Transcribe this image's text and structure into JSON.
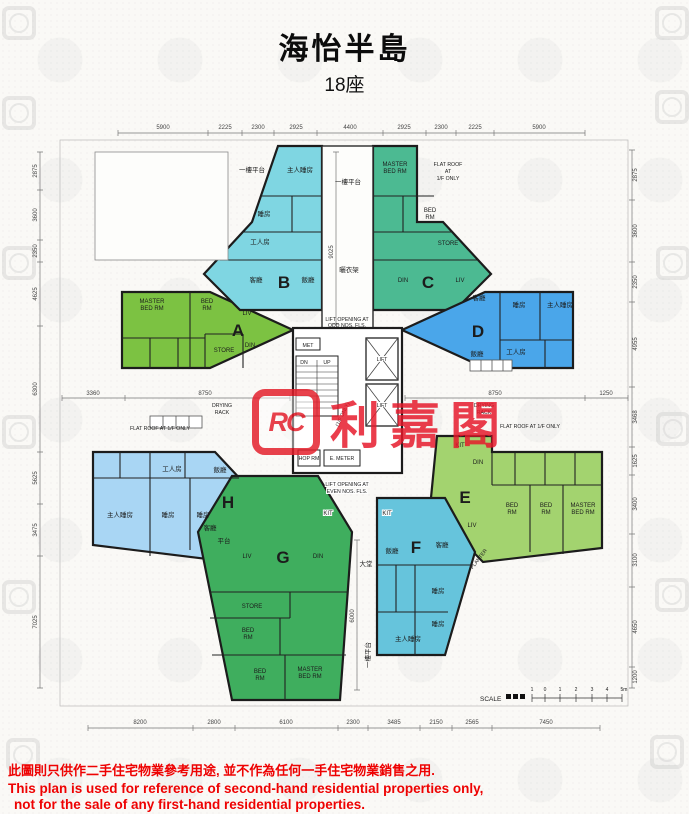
{
  "title": "海怡半島",
  "subtitle": "18座",
  "watermark": {
    "logo_text": "RC",
    "name": "利嘉閣"
  },
  "dims": {
    "top": [
      "5900",
      "2225",
      "2300",
      "2925",
      "4400",
      "2925",
      "2300",
      "2225",
      "5900"
    ],
    "bottom": [
      "8200",
      "2800",
      "6100",
      "2300",
      "3485",
      "2150",
      "2565",
      "7450"
    ],
    "left": [
      "2875",
      "3600",
      "2350",
      "4625",
      "6300",
      "5625",
      "3475",
      "7025"
    ],
    "right": [
      "2875",
      "3600",
      "2350",
      "4955",
      "3468",
      "1625",
      "3400",
      "3100",
      "4650",
      "1200"
    ],
    "mid": {
      "d3360": "3360",
      "d8750_left": "8750",
      "d8750_right": "8750",
      "d1250": "1250",
      "d9025": "9025",
      "d6000": "6000"
    }
  },
  "units": {
    "A": {
      "label": "A",
      "color": "#7cc242",
      "master1": "MASTER",
      "master2": "BED RM",
      "bed1": "BED",
      "bed2": "RM",
      "store": "STORE",
      "liv": "LIV",
      "din": "DIN"
    },
    "B": {
      "label": "B",
      "color": "#7fd6e2",
      "master": "主人睡房",
      "bed": "睡房",
      "maid": "工人房",
      "living": "客廳",
      "dining": "飯廳"
    },
    "C": {
      "label": "C",
      "color": "#4cba92",
      "master1": "MASTER",
      "master2": "BED RM",
      "bed1": "BED",
      "bed2": "RM",
      "store": "STORE",
      "din": "DIN",
      "liv": "LIV"
    },
    "D": {
      "label": "D",
      "color": "#4aa6ea",
      "living": "客廳",
      "bed": "睡房",
      "master": "主人睡房",
      "dining": "飯廳",
      "maid": "工人房"
    },
    "E": {
      "label": "E",
      "color": "#a3d36f",
      "kit": "KIT",
      "din": "DIN",
      "liv": "LIV",
      "bed1a": "BED",
      "bed1b": "RM",
      "bed2a": "BED",
      "bed2b": "RM",
      "master1": "MASTER",
      "master2": "BED RM"
    },
    "F": {
      "label": "F",
      "color": "#66c4dc",
      "kit": "KIT",
      "dining": "飯廳",
      "living": "客廳",
      "bed1": "睡房",
      "bed2": "睡房",
      "master": "主人睡房",
      "planter": "PLANTER"
    },
    "G": {
      "label": "G",
      "color": "#3fae5e",
      "kit": "KIT",
      "liv": "LIV",
      "din": "DIN",
      "store": "STORE",
      "bed1a": "BED",
      "bed1b": "RM",
      "bed2a": "BED",
      "bed2b": "RM",
      "master1": "MASTER",
      "master2": "BED RM"
    },
    "H": {
      "label": "H",
      "color": "#a9d6f4",
      "maid": "工人房",
      "dining": "飯廳",
      "master": "主人睡房",
      "bed1": "睡房",
      "bed2": "睡房",
      "living": "客廳",
      "terrace": "平台"
    }
  },
  "core": {
    "lift_open_odd1": "LIFT OPENING AT",
    "lift_open_odd2": "ODD NOS. FLS.",
    "met": "MET",
    "dn": "DN",
    "up": "UP",
    "lift1": "LIFT",
    "lift2": "LIFT",
    "hop": "HOP RM",
    "emeter": "E. METER",
    "lift_open_even1": "LIFT OPENING AT",
    "lift_open_even2": "EVEN NOS. FLS.",
    "note": "(1/F ONLY)",
    "lobby": "大堂"
  },
  "annotations": {
    "podium_top_left": "一樓平台",
    "podium_top_center": "一樓平台",
    "podium_bottom": "一樓平台",
    "drying_rack_cn": "曬衣架",
    "drying_1": "DRYING",
    "drying_2": "RACK",
    "flat_roof_left": "FLAT ROOF AT 1/F ONLY",
    "flat_roof_bottom_right": "FLAT ROOF AT 1/F ONLY",
    "flat_roof_tr1": "FLAT ROOF",
    "flat_roof_tr2": "AT",
    "flat_roof_tr3": "1/F ONLY"
  },
  "scale": {
    "label": "SCALE",
    "marks": [
      "1",
      "0",
      "1",
      "2",
      "3",
      "4",
      "5m"
    ]
  },
  "disclaimer": {
    "cn": "此圖則只供作二手住宅物業參考用途, 並不作為任何一手住宅物業銷售之用.",
    "en1": "This plan is used for reference of second-hand residential properties only,",
    "en2": "not for the sale of any first-hand residential properties."
  }
}
